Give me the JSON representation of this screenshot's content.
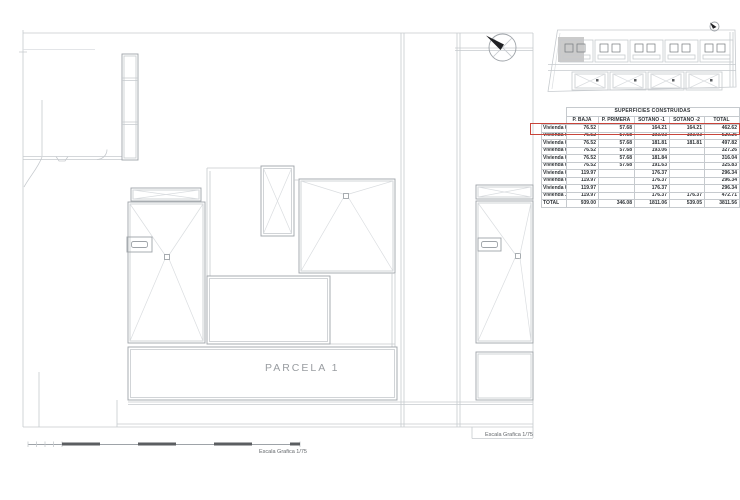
{
  "colors": {
    "line_light": "#c6cace",
    "line_mid": "#9ea3a8",
    "highlight_red": "#c8443a",
    "key_plan_highlight_gray": "#cbcbcb",
    "scalebar_dark": "#5b5e61",
    "table_text": "#2e3236",
    "plan_label_gray": "#999da1"
  },
  "icons": {
    "north_arrow_icon": "circle with diagonal cross and solid black needle pointing north-west",
    "key_plan_north_arrow_icon": "small circle with black needle"
  },
  "plan": {
    "parcela_label": "PARCELA 1",
    "scalebar_label": "Escala Grafica 1/75",
    "frame_scale_label": "Escala Grafica 1/75"
  },
  "table": {
    "title": "SUPERFICIES CONSTRUIDAS",
    "columns": [
      "P. BAJA",
      "P. PRIMERA",
      "SÓTANO -1",
      "SÓTANO -2",
      "TOTAL"
    ],
    "highlight_color": "#c8443a",
    "highlighted_row": "Vivienda 01",
    "rows": [
      {
        "label": "Vivienda 01",
        "values": [
          "76.52",
          "57.68",
          "164.21",
          "164.21",
          "462.62"
        ]
      },
      {
        "label": "Vivienda 02",
        "values": [
          "76.52",
          "57.68",
          "193.03",
          "193.03",
          "520.26"
        ]
      },
      {
        "label": "Vivienda 03",
        "values": [
          "76.52",
          "57.68",
          "181.81",
          "181.81",
          "497.82"
        ]
      },
      {
        "label": "Vivienda 04",
        "values": [
          "76.52",
          "57.68",
          "193.06",
          "",
          "327.26"
        ]
      },
      {
        "label": "Vivienda 05",
        "values": [
          "76.52",
          "57.68",
          "181.84",
          "",
          "316.04"
        ]
      },
      {
        "label": "Vivienda 06",
        "values": [
          "76.52",
          "57.68",
          "191.63",
          "",
          "325.83"
        ]
      },
      {
        "label": "Vivienda 07",
        "values": [
          "119.97",
          "",
          "176.37",
          "",
          "296.34"
        ]
      },
      {
        "label": "Vivienda 08",
        "values": [
          "119.97",
          "",
          "176.37",
          "",
          "296.34"
        ]
      },
      {
        "label": "Vivienda 09",
        "values": [
          "119.97",
          "",
          "176.37",
          "",
          "296.34"
        ]
      },
      {
        "label": "Vivienda 10",
        "values": [
          "119.97",
          "",
          "176.37",
          "176.37",
          "472.71"
        ]
      },
      {
        "label": "TOTAL",
        "values": [
          "939.00",
          "346.08",
          "1811.06",
          "539.05",
          "3811.56"
        ]
      }
    ]
  }
}
